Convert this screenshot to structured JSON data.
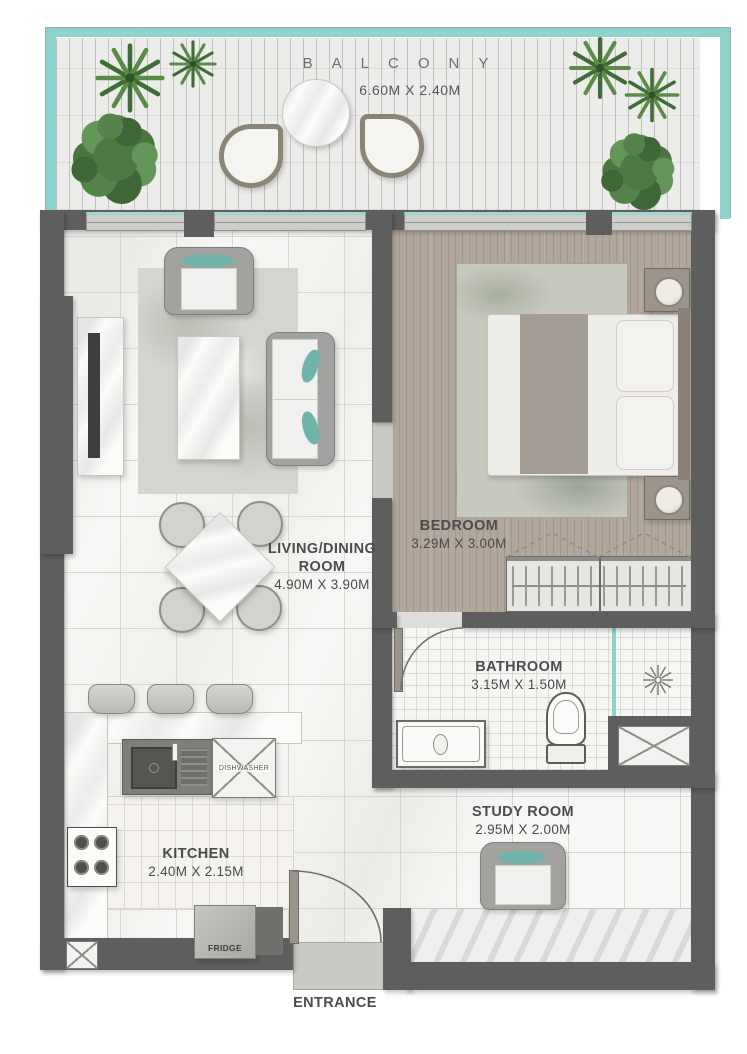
{
  "rooms": {
    "balcony": {
      "name": "BALCONY",
      "dims": "6.60M X 2.40M"
    },
    "living_dining": {
      "name": "LIVING/DINING ROOM",
      "dims": "4.90M X 3.90M"
    },
    "bedroom": {
      "name": "BEDROOM",
      "dims": "3.29M X 3.00M"
    },
    "bathroom": {
      "name": "BATHROOM",
      "dims": "3.15M X 1.50M"
    },
    "study": {
      "name": "STUDY ROOM",
      "dims": "2.95M X 2.00M"
    },
    "kitchen": {
      "name": "KITCHEN",
      "dims": "2.40M X 2.15M"
    }
  },
  "labels": {
    "entrance": "ENTRANCE",
    "fridge": "FRIDGE",
    "dishwasher": "DISHWASHER"
  },
  "colors": {
    "wall": "#5e5e5e",
    "glass_railing": "#8ed2cc",
    "teal_accent": "#6fb3ab",
    "wood_floor": "#b2a79c",
    "marble_floor": "#f7f7f5",
    "label_text": "#4c4c4c"
  }
}
